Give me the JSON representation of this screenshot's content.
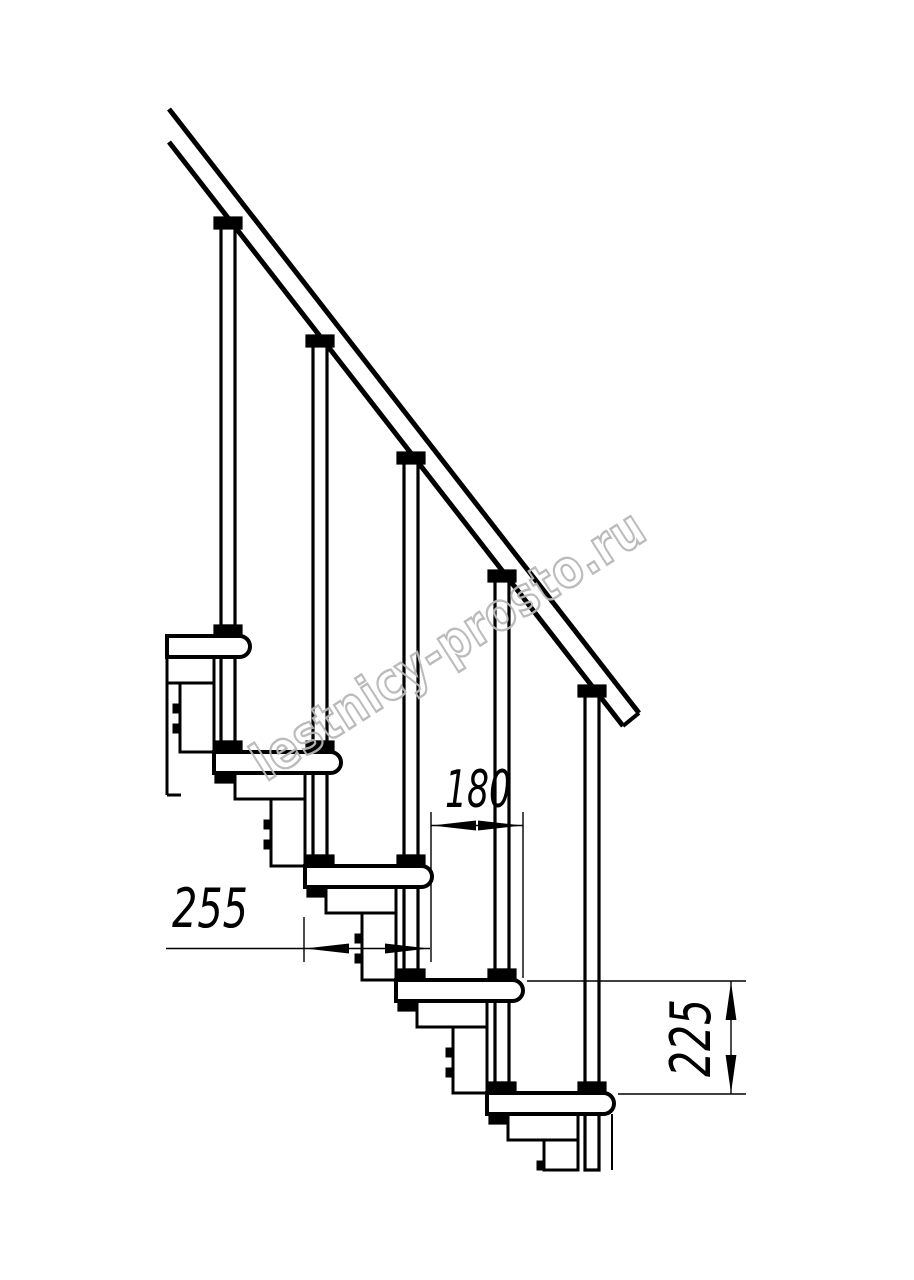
{
  "canvas": {
    "width": 914,
    "height": 1280,
    "background": "#ffffff",
    "ink": "#000000"
  },
  "drawing": {
    "kind": "modular-staircase-side-elevation",
    "steps_visible": 5,
    "baluster_rods_visible": 5,
    "handrail_present": true
  },
  "dimensions": {
    "tread_depth": "255",
    "step_run": "180",
    "step_rise": "225"
  },
  "watermark": {
    "text": "lestnicy-prosto.ru",
    "color": "#b8b8b8"
  }
}
